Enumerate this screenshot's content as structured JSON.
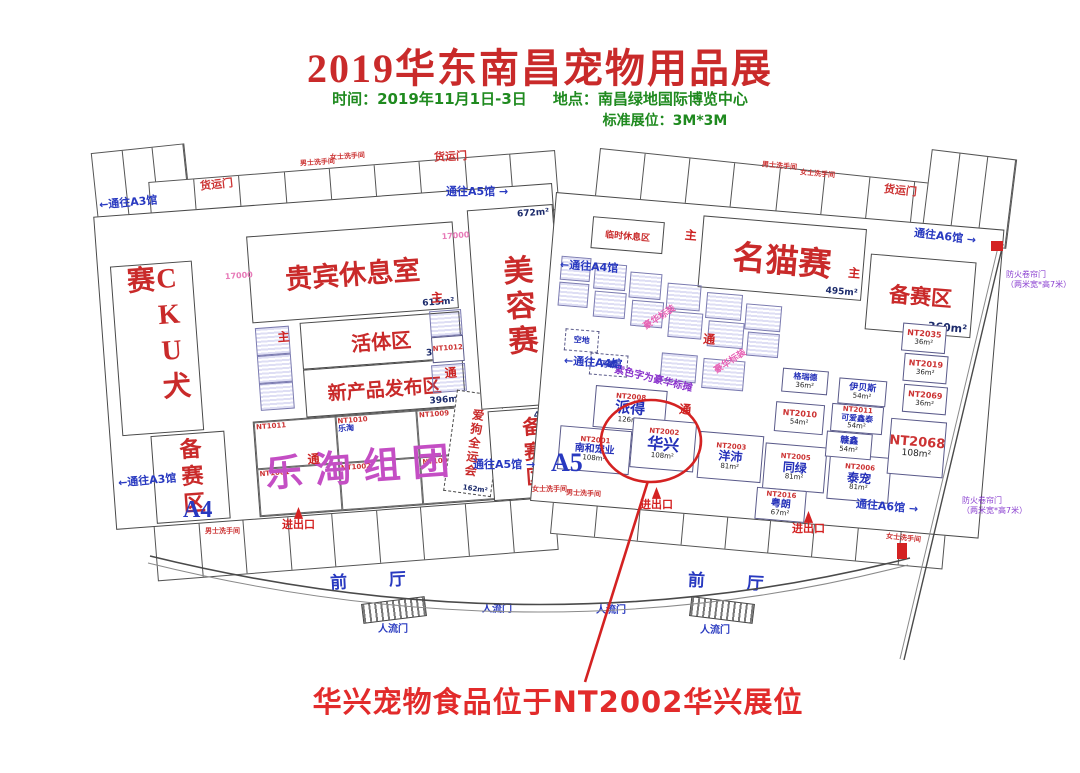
{
  "header": {
    "title": "2019华东南昌宠物用品展",
    "time": "时间：2019年11月1日-3日",
    "place": "地点：南昌绿地国际博览中心",
    "booth_spec": "标准展位：3M*3M"
  },
  "halls": {
    "a4_label": "A4",
    "a5_label": "A5",
    "left": {
      "cku": "CKU犬赛",
      "prep_left": "备赛区",
      "vip": {
        "name": "贵宾休息室",
        "area": "615m²"
      },
      "live": {
        "name": "活体区",
        "area": "396m²"
      },
      "newproduct": {
        "name": "新产品发布区",
        "area": "396m²"
      },
      "letao": "乐淘组团",
      "letao_booths": [
        {
          "id": "NT1011"
        },
        {
          "id": "NT1010",
          "name": "乐淘"
        },
        {
          "id": "NT1009"
        },
        {
          "id": "NT1001"
        },
        {
          "id": "NT1002"
        },
        {
          "id": "NT1003"
        }
      ],
      "nt1012": "NT1012",
      "doggames": {
        "name": "爱狗全运会",
        "area": "162m²"
      },
      "beauty": {
        "name": "美容赛",
        "area": "672m²"
      },
      "prep_mid": {
        "name": "备赛区",
        "area": "486m²"
      }
    },
    "right": {
      "catshow": {
        "name": "名猫赛",
        "area": "495m²"
      },
      "prep_right": {
        "name": "备赛区",
        "area": "360m²"
      },
      "rest": "临时休息区",
      "booths": [
        {
          "id": "NT2008",
          "name": "派得",
          "area": "126m²"
        },
        {
          "id": "NT2002",
          "name": "华兴",
          "area": "108m²"
        },
        {
          "id": "NT2001",
          "name": "南和宠业",
          "area": "108m²"
        },
        {
          "id": "NT2003",
          "name": "洋沛",
          "area": "81m²"
        },
        {
          "id": "NT2005",
          "name": "同绿",
          "area": "81m²"
        },
        {
          "id": "NT2006",
          "name": "泰宠",
          "area": "81m²"
        },
        {
          "id": "NT2016",
          "name": "粤朗",
          "area": "67m²"
        },
        {
          "id": "NT2010",
          "area": "54m²"
        },
        {
          "id": "NT2011",
          "name": "可爱鑫泰",
          "area": "54m²"
        },
        {
          "name": "赣鑫",
          "area": "54m²"
        },
        {
          "name": "伊贝斯",
          "area": "54m²"
        },
        {
          "name": "格瑞德",
          "area": "36m²"
        },
        {
          "id": "NT2035",
          "area": "36m²"
        },
        {
          "id": "NT2019",
          "area": "36m²"
        },
        {
          "id": "NT2069",
          "area": "36m²"
        },
        {
          "id": "NT2068",
          "area": "108m²"
        },
        {
          "name": "空地"
        },
        {
          "name": "万霸"
        }
      ],
      "deluxe_note": "豪华标装",
      "purple_note": "紫色字为豪华标摊"
    }
  },
  "doors": {
    "cargo": "货运门",
    "people": "人流门",
    "inout": "进出口",
    "fire1": "防火卷帘门",
    "fire2": "（两米宽*高7米）"
  },
  "nav": {
    "a3": "←通往A3馆",
    "a4": "←通往A4馆",
    "a5": "通往A5馆 →",
    "a6": "通往A6馆 →"
  },
  "marks": {
    "aisle": "通",
    "main": "主",
    "dim": "17000"
  },
  "lobby": "前 厅",
  "restroom": {
    "male": "男士洗手间",
    "female": "女士洗手间"
  },
  "annotation": "华兴宠物食品位于NT2002华兴展位"
}
